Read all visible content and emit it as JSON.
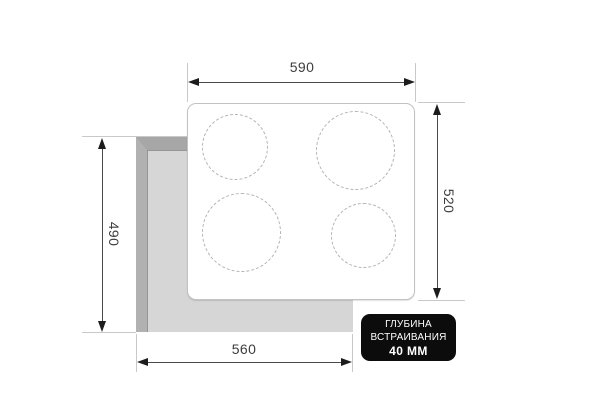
{
  "diagram": {
    "type": "built-in-cooktop-cutout-dimensions",
    "dims": {
      "top": {
        "value": "590",
        "meaning": "appliance width"
      },
      "right": {
        "value": "520",
        "meaning": "appliance depth"
      },
      "left": {
        "value": "490",
        "meaning": "cutout depth"
      },
      "bottom": {
        "value": "560",
        "meaning": "cutout width"
      }
    },
    "burners": [
      {
        "position": "top-left",
        "size": "small"
      },
      {
        "position": "top-right",
        "size": "large"
      },
      {
        "position": "bottom-left",
        "size": "large"
      },
      {
        "position": "bottom-right",
        "size": "small"
      }
    ],
    "badge": {
      "line1": "ГЛУБИНА",
      "line2": "ВСТРАИВАНИЯ",
      "line3": "40 ММ"
    },
    "colors": {
      "background": "#ffffff",
      "cutout_fill": "#d6d6d6",
      "cutout_bevel_top": "#a7a7a7",
      "cutout_bevel_left": "#b1b1b1",
      "panel_border": "#c2c2c2",
      "burner_dash": "#b3b3b3",
      "dimension_line": "#4a4a4a",
      "extension_line": "#c9c9c9",
      "label_text": "#3d3d3d",
      "badge_bg": "#0c0c0c",
      "badge_text": "#ffffff"
    }
  }
}
